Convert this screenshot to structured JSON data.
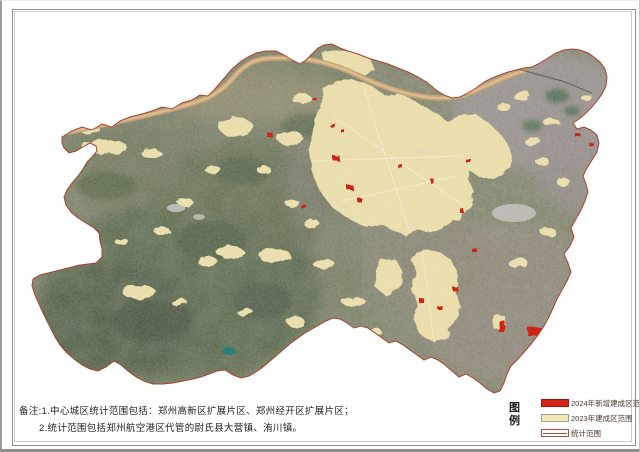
{
  "notes": {
    "line1": "备注:1.中心城区统计范围包括：郑州高新区扩展片区、郑州经开区扩展片区；",
    "line2": "2.统计范围包括郑州航空港区代管的尉氏县大营镇、洧川镇。"
  },
  "legend": {
    "title": "图例",
    "items": [
      {
        "label": "2024年新增建成区范围",
        "swatch": "filled-red",
        "color": "#d22318"
      },
      {
        "label": "2023年建成区范围",
        "swatch": "filled-cream",
        "color": "#f2e7ba"
      },
      {
        "label": "统计范围",
        "swatch": "outline-line",
        "color": "#b0503c"
      }
    ]
  },
  "map": {
    "colors": {
      "built_up_2023": "#e8dca6",
      "built_up_2024": "#d02014",
      "statistical_boundary": "#a8432f",
      "river": "#c9a577",
      "terrain_base": "#767a5f"
    }
  }
}
